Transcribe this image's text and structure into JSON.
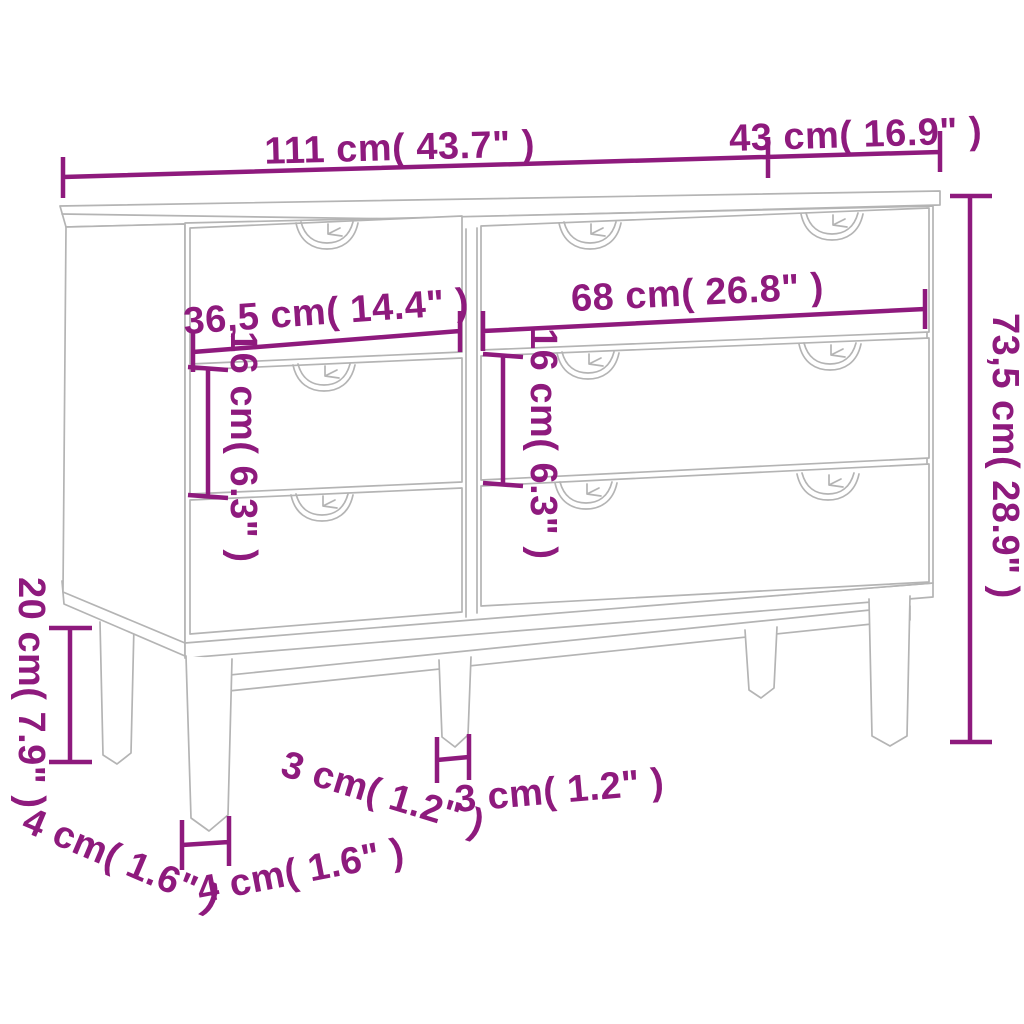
{
  "diagram": {
    "colors": {
      "dimension_accent": "#8e1a7d",
      "furniture_line": "#b4b4b4",
      "background": "#ffffff"
    },
    "dimensions": {
      "overall_width": {
        "label": "111 cm( 43.7\" )",
        "cm": 111,
        "inches": 43.7
      },
      "overall_depth": {
        "label": "43 cm( 16.9\" )",
        "cm": 43,
        "inches": 16.9
      },
      "left_drawer_width": {
        "label": "36,5 cm( 14.4\" )",
        "cm": 36.5,
        "inches": 14.4
      },
      "right_drawer_width": {
        "label": "68 cm( 26.8\" )",
        "cm": 68,
        "inches": 26.8
      },
      "left_drawer_height": {
        "label": "16 cm( 6.3\" )",
        "cm": 16,
        "inches": 6.3
      },
      "right_drawer_height": {
        "label": "16 cm( 6.3\" )",
        "cm": 16,
        "inches": 6.3
      },
      "overall_height": {
        "label": "73,5 cm( 28.9\" )",
        "cm": 73.5,
        "inches": 28.9
      },
      "leg_height": {
        "label": "20 cm( 7.9\" )",
        "cm": 20,
        "inches": 7.9
      },
      "leg_depth_angled": {
        "label": "3 cm( 1.2\" )",
        "cm": 3,
        "inches": 1.2
      },
      "leg_depth": {
        "label": "3 cm( 1.2\" )",
        "cm": 3,
        "inches": 1.2
      },
      "leg_width_angled": {
        "label": "4 cm( 1.6\" )",
        "cm": 4,
        "inches": 1.6
      },
      "leg_width": {
        "label": "4 cm( 1.6\" )",
        "cm": 4,
        "inches": 1.6
      }
    }
  }
}
